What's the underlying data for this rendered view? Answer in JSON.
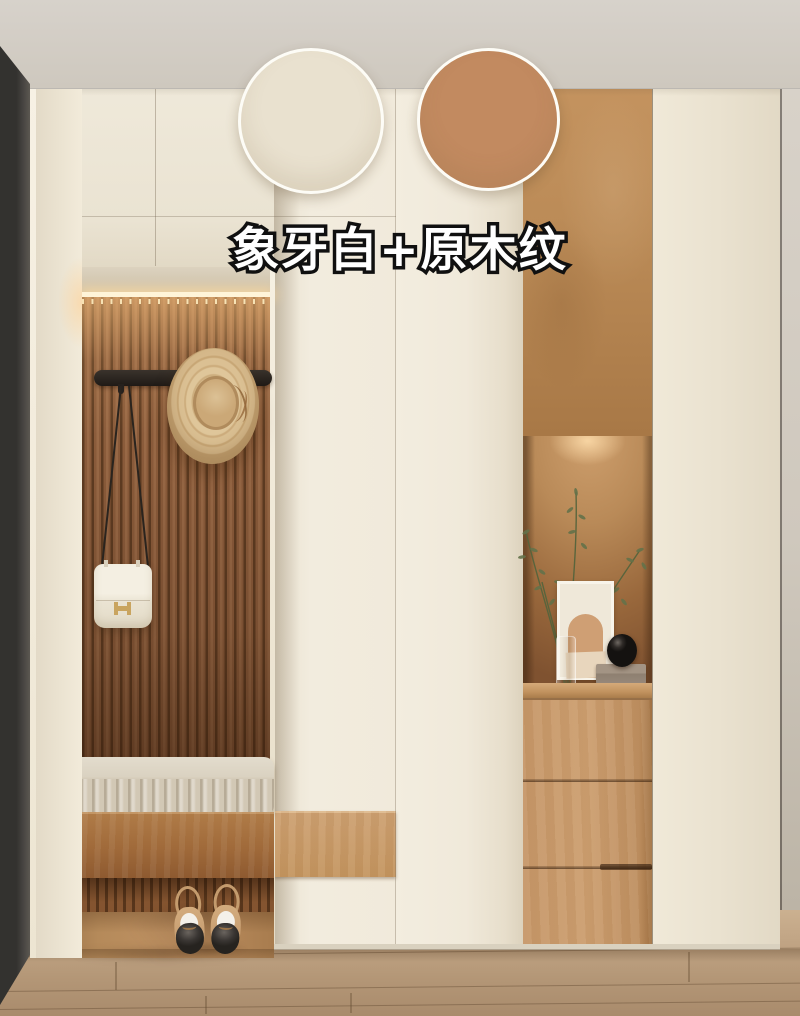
{
  "overlay": {
    "title": "象牙白+原木纹",
    "title_fill": "#ffffff",
    "title_outline": "#101010"
  },
  "swatches": [
    {
      "label": "象牙白",
      "color": "#E9E1CF"
    },
    {
      "label": "原木纹",
      "color": "#C28A60"
    }
  ],
  "palette": {
    "ceiling": "#D2CCC4",
    "cream_cabinet": "#EFE8D8",
    "slat_wood": "#8B5C3B",
    "light_wood": "#C89A6B",
    "niche_glow": "#C89868",
    "floor": "#C2A685",
    "dark_door": "#3A3835",
    "led_strip": "#FFF4D8"
  }
}
